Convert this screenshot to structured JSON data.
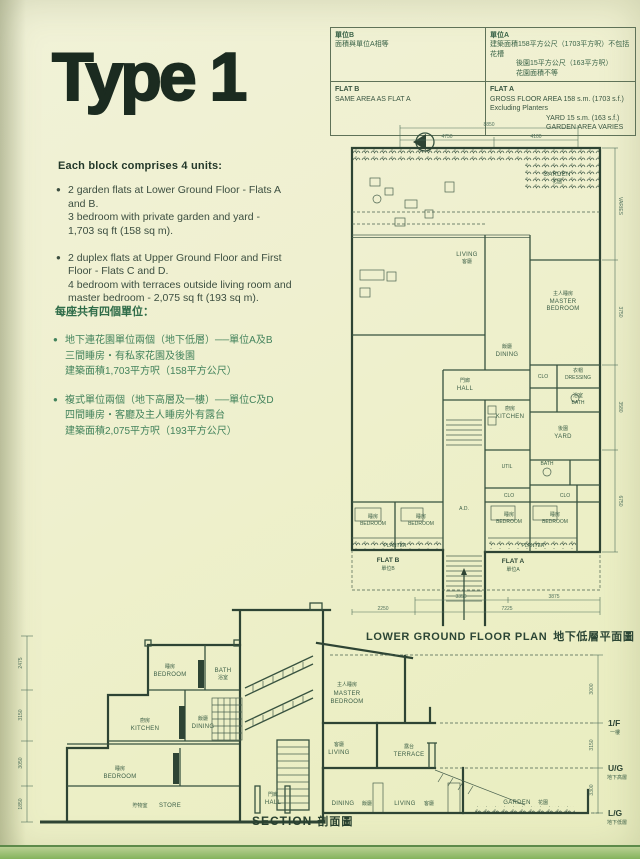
{
  "colors": {
    "paper": "#eff0cf",
    "ink": "#2e4434",
    "green_text": "#3f7b55",
    "band_green": "#84b35c"
  },
  "page": {
    "type_title": "Type 1",
    "bullet_glyph": "●"
  },
  "intro": {
    "heading": "Each block comprises 4 units:",
    "bullets": [
      {
        "lines": [
          "2 garden flats at Lower Ground Floor - Flats A",
          "and B.",
          "3 bedroom with private garden and yard -",
          "1,703 sq ft (158 sq m)."
        ]
      },
      {
        "lines": [
          "2 duplex flats at Upper Ground Floor and First",
          "Floor - Flats C and D.",
          "4 bedroom with terraces outside living room and",
          "master bedroom - 2,075 sq ft (193 sq m)."
        ]
      }
    ]
  },
  "intro_zh": {
    "heading": "每座共有四個單位：",
    "bullets": [
      {
        "lines": [
          "地下連花園單位兩個（地下低層）──單位A及B",
          "三間睡房・有私家花園及後園",
          "建築面積1,703平方呎（158平方公尺）"
        ]
      },
      {
        "lines": [
          "複式單位兩個（地下高層及一樓）──單位C及D",
          "四間睡房・客廳及主人睡房外有露台",
          "建築面積2,075平方呎（193平方公尺）"
        ]
      }
    ]
  },
  "spec_table": {
    "flat_b_zh": [
      "單位B",
      "面積與單位A相等"
    ],
    "flat_a_zh": [
      "單位A",
      "建築面積158平方公尺（1703平方呎）不包括花槽",
      "後園15平方公尺（163平方呎）",
      "花園面積不等"
    ],
    "flat_b_en": [
      "FLAT B",
      "SAME AREA AS FLAT A"
    ],
    "flat_a_en": [
      "FLAT A",
      "GROSS FLOOR AREA 158 s.m. (1703 s.f.) Excluding Planters",
      "YARD 15 s.m. (163 s.f.)",
      "GARDEN AREA VARIES"
    ]
  },
  "plan": {
    "caption_en": "LOWER GROUND FLOOR PLAN",
    "caption_zh": "地下低層平面圖",
    "labels": {
      "garden_en": "GARDEN",
      "garden_zh": "花園",
      "living_en": "LIVING",
      "living_zh": "客廳",
      "master_zh": "主人睡房",
      "master_en1": "MASTER",
      "master_en2": "BEDROOM",
      "dining_zh": "飯廳",
      "dining_en": "DINING",
      "hall_en": "HALL",
      "hall_zh": "門廊",
      "kitchen_zh": "廚房",
      "kitchen_en": "KITCHEN",
      "yard_zh": "後園",
      "yard_en": "YARD",
      "clo1": "CLO",
      "dressing_zh": "衣帽",
      "dressing_en": "DRESSING",
      "bath1_zh": "浴室",
      "bath1_en": "BATH",
      "util_en": "UTIL",
      "bath2_en": "BATH",
      "clo2": "CLO",
      "clo3": "CLO",
      "bedb1_zh": "睡房",
      "bedb1_en": "BEDROOM",
      "bedb2_zh": "睡房",
      "bedb2_en": "BEDROOM",
      "beda1_zh": "睡房",
      "beda1_en": "BEDROOM",
      "beda2_zh": "睡房",
      "beda2_en": "BEDROOM",
      "planter1": "PLANTER",
      "planter2": "PLANTER",
      "flatb_en": "FLAT B",
      "flatb_zh": "單位B",
      "flata_en": "FLAT A",
      "flata_zh": "單位A",
      "ad": "A.D."
    },
    "dims": {
      "top_total": "8850",
      "top_a": "4750",
      "top_b": "4100",
      "right": [
        "VARIES",
        "3750",
        "3580",
        "6750"
      ],
      "bottom_inner": [
        "3350",
        "3875"
      ],
      "bottom_outer": [
        "2250",
        "7225"
      ]
    }
  },
  "section": {
    "caption_en": "SECTION",
    "caption_zh": "剖面圖",
    "labels": {
      "bed_u_zh": "睡房",
      "bed_u_en": "BEDROOM",
      "bath_en": "BATH",
      "bath_zh": "浴室",
      "kit_zh": "廚房",
      "kit_en": "KITCHEN",
      "din_u_zh": "飯廳",
      "din_u_en": "DINING",
      "bed_l_zh": "睡房",
      "bed_l_en": "BEDROOM",
      "store_zh": "貯物室",
      "store_en": "STORE",
      "master_zh": "主人睡房",
      "master_en1": "MASTER",
      "master_en2": "BEDROOM",
      "liv_u_zh": "客廳",
      "liv_u_en": "LIVING",
      "ter_zh": "露台",
      "ter_en": "TERRACE",
      "hall_zh": "門廊",
      "hall_en": "HALL",
      "din_l_en": "DINING",
      "din_l_zh": "飯廳",
      "liv_l_en": "LIVING",
      "liv_l_zh": "客廳",
      "garden_en": "GARDEN",
      "garden_zh": "花園"
    },
    "levels": [
      {
        "en": "1/F",
        "zh": "一樓"
      },
      {
        "en": "U/G",
        "zh": "地下高層"
      },
      {
        "en": "L/G",
        "zh": "地下低層"
      }
    ],
    "dims_left": [
      "2475",
      "3150",
      "3050",
      "1850"
    ],
    "dims_right": [
      "3000",
      "3150",
      "3300"
    ]
  }
}
